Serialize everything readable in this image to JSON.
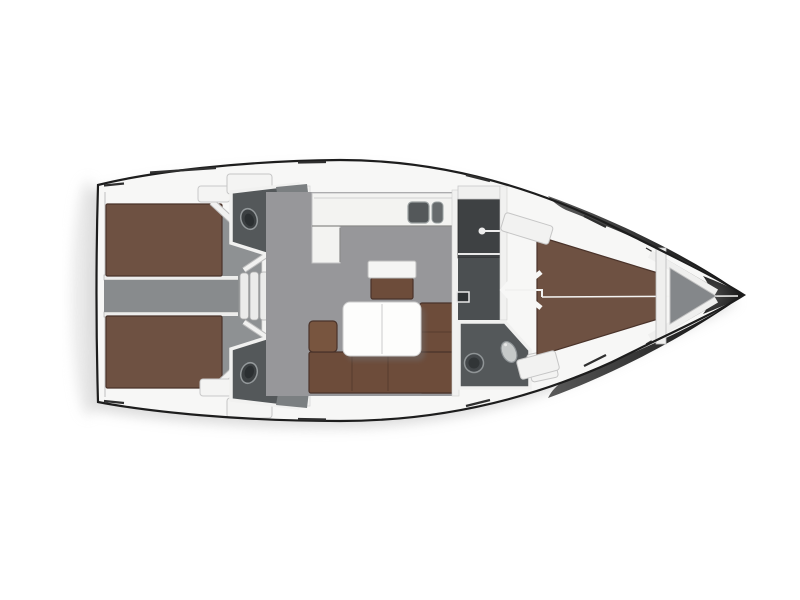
{
  "diagram": {
    "kind": "sailing-yacht-interior-floorplan",
    "orientation": "bow-right"
  },
  "colors": {
    "page_bg": "#ffffff",
    "deck": "#f7f7f6",
    "outline": "#1d1d1d",
    "shadow": "#bfbfbf",
    "floor": "#97979a",
    "cabin_floor": "#8e9193",
    "corridor": "#888b8d",
    "berth": "#6e5142",
    "berth_edge": "#4a332a",
    "sofa": "#6d4c3a",
    "armrest": "#78553f",
    "head_floor": "#54585a",
    "counter": "#7b7f81",
    "fixture": "#c6c9c9",
    "locker_dark": "#3e4143",
    "hallway": "#4b4f51",
    "wall": "#f2f2f1",
    "step": "#ebebea",
    "table": "#fdfdfc",
    "anchor_locker": "#84878a",
    "bow_dark_1": "#5a5a5a",
    "bow_dark_2": "#0b0b0b",
    "sink_basin": "#54585a",
    "toilet_dark": "#3c4042",
    "white_line": "#f4f4f2"
  }
}
